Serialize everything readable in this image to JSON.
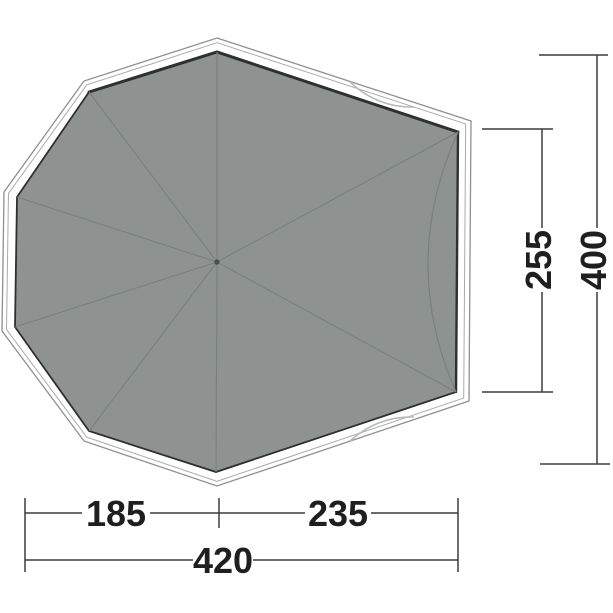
{
  "diagram": {
    "type": "tent-footprint-top-view",
    "shape": "octagonal groundsheet with flattened front edge, radial seams from center pole point"
  },
  "dimensions": {
    "bottom_left_segment": "185",
    "bottom_right_segment": "235",
    "total_width": "420",
    "front_edge_height": "255",
    "total_depth": "400"
  },
  "colors": {
    "background": "#ffffff",
    "floor_fill": "#8e9391",
    "floor_edge": "#2e302f",
    "seam": "#7a807e",
    "outline": "#8f908f",
    "hem_outline": "#a8a9a8",
    "dimension_line": "#3c3c3c",
    "label_text": "#1f1f1f",
    "door_arc": "#b7bcba"
  }
}
